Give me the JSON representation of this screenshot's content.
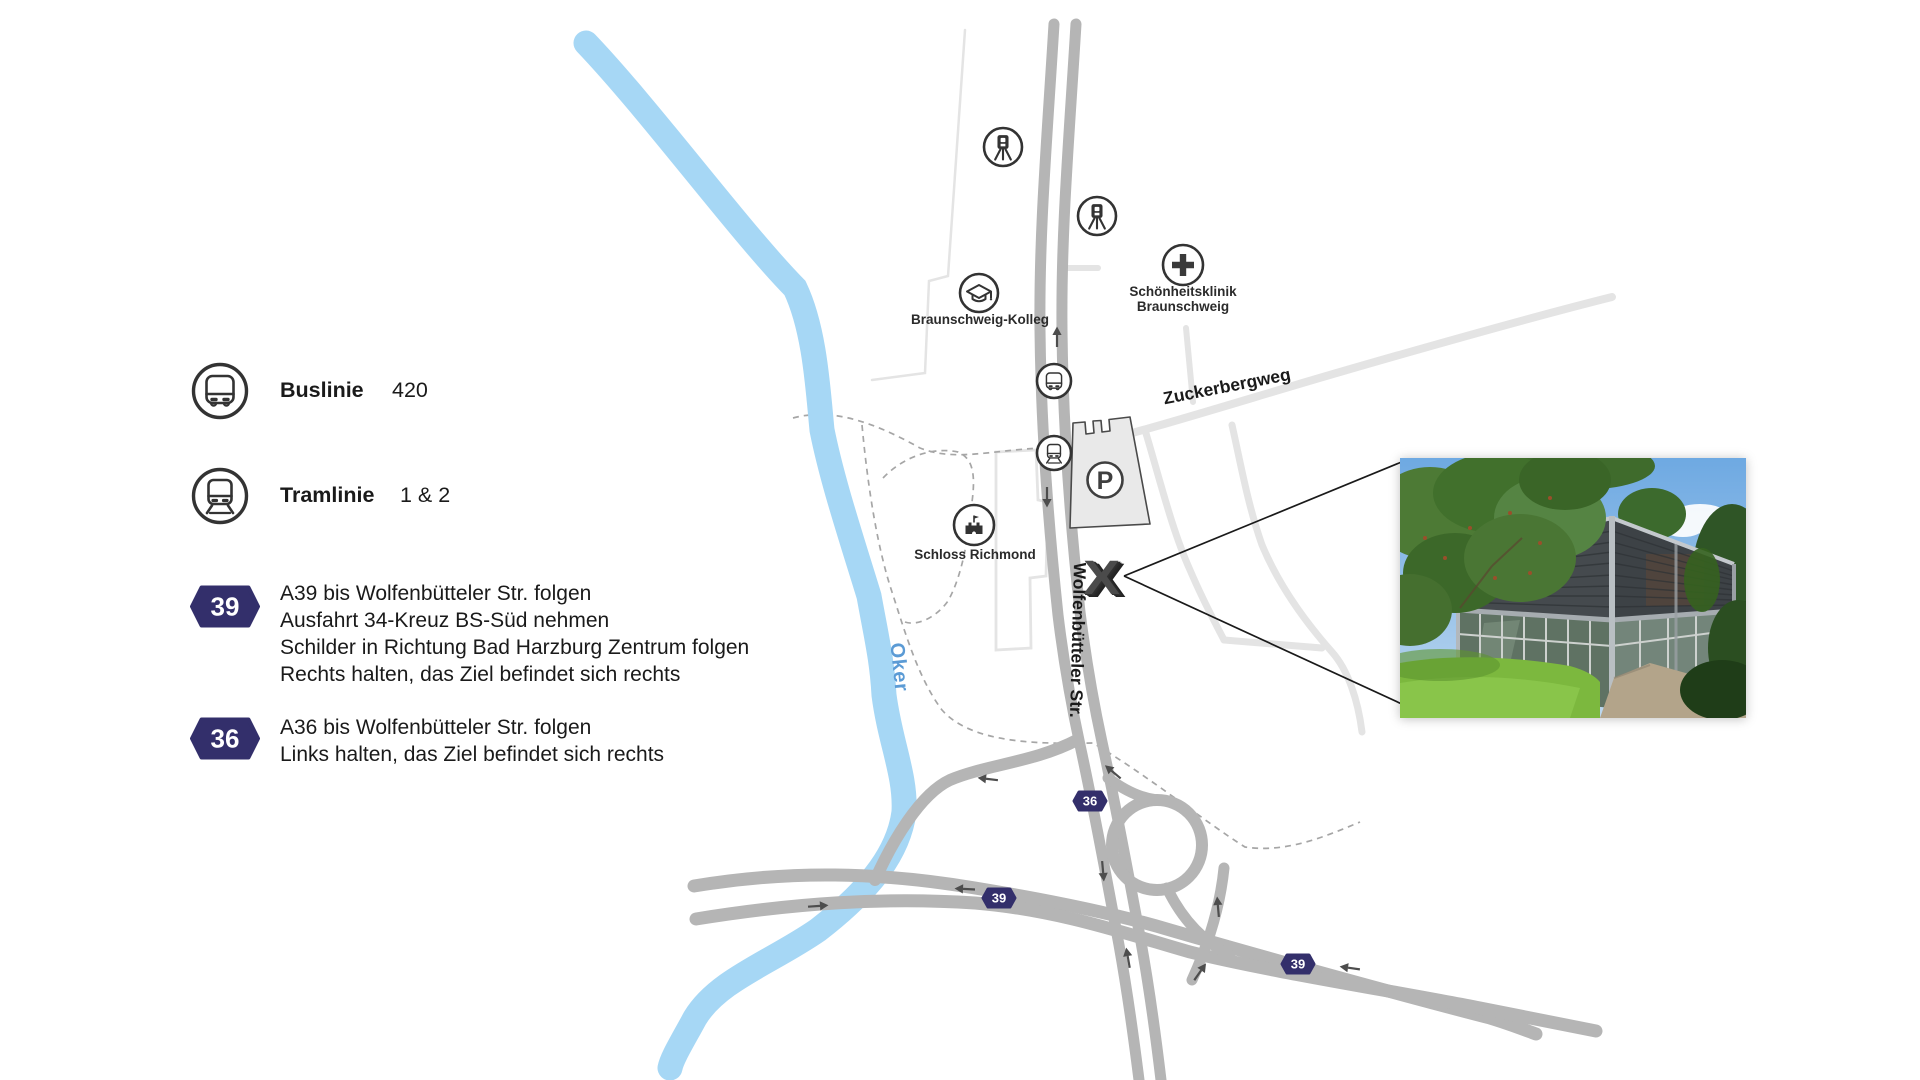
{
  "legend": {
    "bus_label": "Buslinie",
    "bus_value": "420",
    "tram_label": "Tramlinie",
    "tram_value": "1 & 2",
    "a39_badge": "39",
    "a39_lines": [
      "A39 bis Wolfenbütteler Str. folgen",
      "Ausfahrt 34-Kreuz BS-Süd nehmen",
      "Schilder in Richtung Bad Harzburg Zentrum folgen",
      "Rechts halten, das Ziel befindet sich rechts"
    ],
    "a36_badge": "36",
    "a36_lines": [
      "A36 bis Wolfenbütteler Str. folgen",
      "Links halten, das Ziel befindet sich rechts"
    ]
  },
  "map": {
    "streets": {
      "zuckerbergweg": "Zuckerbergweg",
      "wolfenbuetteler": "Wolfenbütteler Str."
    },
    "river_label": "Oker",
    "pois": [
      {
        "name": "braunschweig-kolleg",
        "label": "Braunschweig-Kolleg"
      },
      {
        "name": "schoenheitsklinik",
        "lines": [
          "Schönheitsklinik",
          "Braunschweig"
        ]
      },
      {
        "name": "schloss-richmond",
        "label": "Schloss Richmond"
      }
    ],
    "parking_label": "P",
    "marker": "X",
    "route_badges": {
      "b36": "36",
      "b39_west": "39",
      "b39_east": "39"
    }
  },
  "colors": {
    "badge_navy": "#332f6b",
    "river_blue": "#a6d7f5",
    "river_label_blue": "#5b9bd5",
    "road_gray": "#b5b5b5",
    "side_street_gray": "#e4e4e4",
    "icon_dark": "#333333",
    "text_dark": "#1a1a1a"
  }
}
